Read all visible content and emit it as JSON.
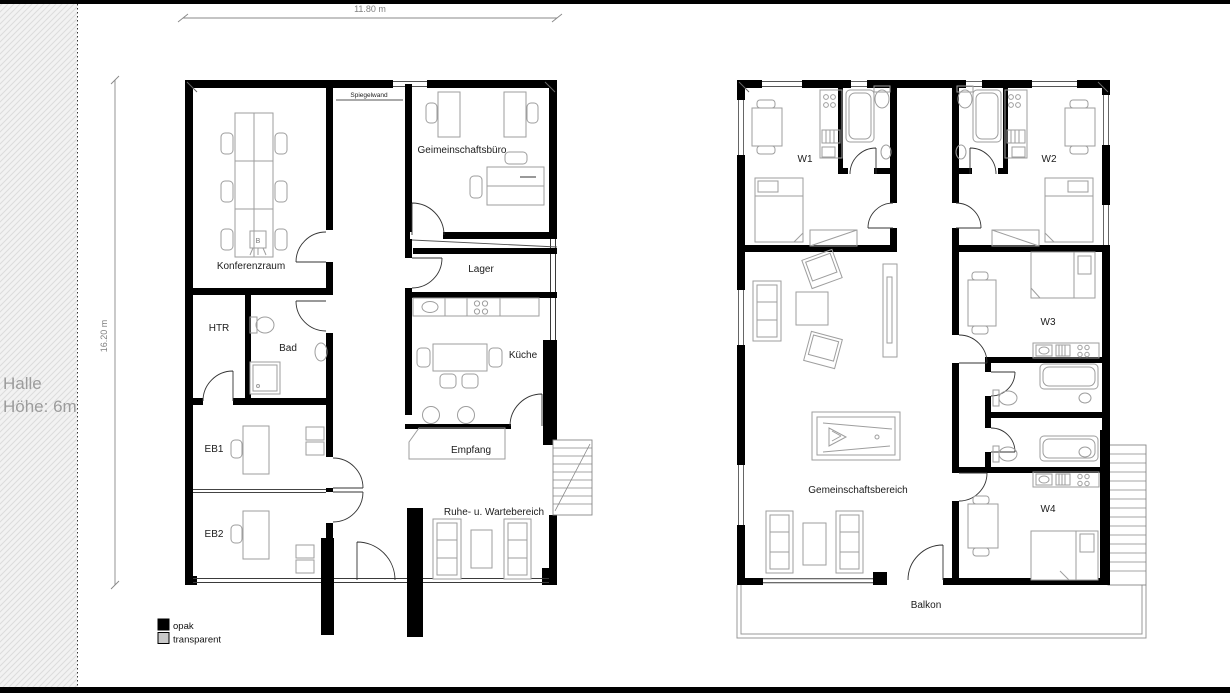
{
  "window": {
    "frame_color": "#000000",
    "background": "#ffffff"
  },
  "hall_area": {
    "line1": "Halle",
    "line2": "Höhe: 6m"
  },
  "dimensions": {
    "width_label": "11.80 m",
    "height_label": "16.20 m"
  },
  "office_plan": {
    "rooms": {
      "spiegelwand": "Spiegelwand",
      "gemeinschaftsbuero": "Geimeinschaftsbüro",
      "konferenzraum": "Konferenzraum",
      "lager": "Lager",
      "htr": "HTR",
      "bad": "Bad",
      "kueche": "Küche",
      "empfang": "Empfang",
      "eb1": "EB1",
      "eb2": "EB2",
      "ruhe_wartebereich": "Ruhe- u. Wartebereich"
    },
    "flipchart_symbol": "B"
  },
  "residential_plan": {
    "rooms": {
      "w1": "W1",
      "w2": "W2",
      "w3": "W3",
      "w4": "W4",
      "gemeinschaftsbereich": "Gemeinschaftsbereich",
      "balkon": "Balkon"
    }
  },
  "legend": {
    "items": [
      {
        "label": "opak",
        "swatch": "#000000"
      },
      {
        "label": "transparent",
        "swatch": "#c9c9c9"
      }
    ]
  }
}
